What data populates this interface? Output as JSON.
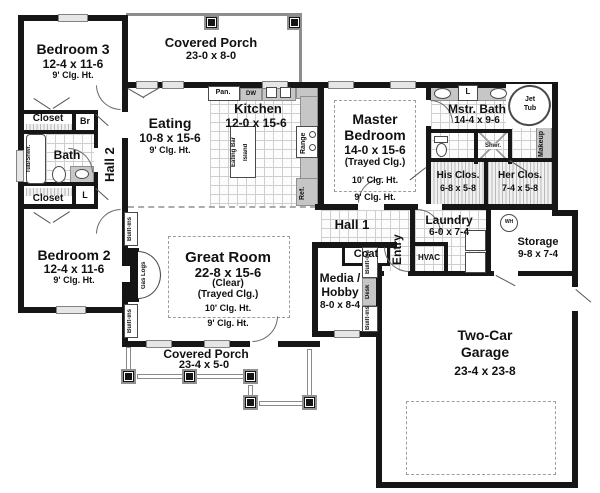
{
  "rooms": {
    "bedroom3": {
      "name": "Bedroom 3",
      "dims": "12-4 x 11-6",
      "clg": "9' Clg. Ht."
    },
    "porch_top": {
      "name": "Covered Porch",
      "dims": "23-0 x 8-0"
    },
    "eating": {
      "name": "Eating",
      "dims": "10-8 x 15-6",
      "clg": "9' Clg. Ht."
    },
    "kitchen": {
      "name": "Kitchen",
      "dims": "12-0 x 15-6"
    },
    "master": {
      "name_line1": "Master",
      "name_line2": "Bedroom",
      "dims": "14-0 x 15-6",
      "note": "(Trayed Clg.)",
      "clg10": "10' Clg. Ht.",
      "clg9": "9' Clg. Ht."
    },
    "mbath": {
      "name": "Mstr. Bath",
      "dims": "14-4 x 9-6"
    },
    "his_closet": {
      "name": "His Clos.",
      "dims": "6-8 x 5-8"
    },
    "her_closet": {
      "name": "Her Clos.",
      "dims": "7-4 x 5-8"
    },
    "bath": {
      "name": "Bath"
    },
    "hall2": {
      "name": "Hall 2"
    },
    "hall1": {
      "name": "Hall 1"
    },
    "bedroom2": {
      "name": "Bedroom 2",
      "dims": "12-4 x 11-6",
      "clg": "9' Clg. Ht."
    },
    "great_room": {
      "name": "Great Room",
      "dims": "22-8 x 15-6",
      "note1": "(Clear)",
      "note2": "(Trayed Clg.)",
      "clg10": "10' Clg. Ht.",
      "clg9": "9' Clg. Ht."
    },
    "media": {
      "name_line1": "Media /",
      "name_line2": "Hobby",
      "dims": "8-0 x 8-4"
    },
    "coat": {
      "name": "Coat"
    },
    "entry": {
      "name": "Entry"
    },
    "hvac": {
      "name": "HVAC"
    },
    "laundry": {
      "name": "Laundry",
      "dims": "6-0 x 7-4"
    },
    "storage": {
      "name": "Storage",
      "dims": "9-8 x 7-4"
    },
    "garage": {
      "name_line1": "Two-Car",
      "name_line2": "Garage",
      "dims": "23-4 x 23-8"
    },
    "porch_bottom": {
      "name": "Covered Porch",
      "dims": "23-4 x 5-0"
    }
  },
  "fixtures": {
    "closet_bedroom3": "Closet",
    "broom": "Br",
    "linen_hall": "L",
    "closet_bedroom2": "Closet",
    "tub_shower": "Tub/Shwr.",
    "pantry": "Pan.",
    "dishwasher": "DW",
    "range": "Range",
    "refrigerator": "Ref.",
    "eating_bar": "Eating Bar",
    "island": "Island",
    "jet_line1": "Jet",
    "jet_line2": "Tub",
    "linen_bath": "L",
    "shower": "Shwr.",
    "makeup": "Makeup",
    "water_heater": "WH",
    "gas_logs": "Gas Logs",
    "built_ins": "Built-ins",
    "desk": "Desk"
  },
  "colors": {
    "wall": "#161616",
    "tile_line": "#c9c9c9",
    "window_fill": "#e6e6e6",
    "counter": "#c4c4c4",
    "dash": "#9e9e9e"
  }
}
